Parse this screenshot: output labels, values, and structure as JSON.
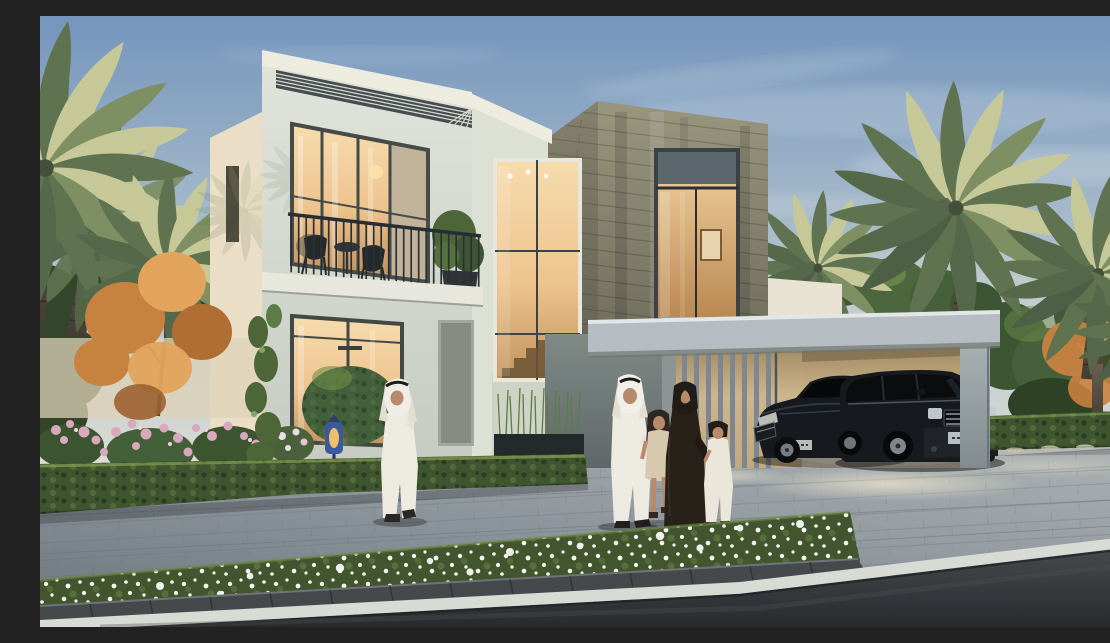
{
  "scene": {
    "type": "architectural-exterior-rendering",
    "description": "Dusk rendering of a modern two-storey villa: white block with louvred roof edge and balcony, double-height stair window, stone-clad wing with glowing window, slatted entrance screen, open carport sheltering a dark sedan and SUV, an Emirati family of four walking on the block-paved driveway, a man in a white kandura on the phone, date palms, autumn trees, pink shrubs, clipped hedges, a foreground bed of white daisies and an asphalt road with a white edge line.",
    "objects": [
      {
        "name": "villa-left-block",
        "label": "white two-storey block with roof louvres"
      },
      {
        "name": "balcony",
        "label": "balcony with metal railing, two chairs and bistro table"
      },
      {
        "name": "stairwell-window",
        "label": "double-height stair window, warm lit"
      },
      {
        "name": "stone-block",
        "label": "stone-clad volume with tall lit window"
      },
      {
        "name": "entrance-gate",
        "label": "vertical slatted entrance screen"
      },
      {
        "name": "carport",
        "label": "open carport with two parked cars"
      },
      {
        "name": "suv",
        "label": "dark luxury SUV"
      },
      {
        "name": "sedan",
        "label": "dark luxury sedan"
      },
      {
        "name": "family-group",
        "label": "father, mother, daughter and son walking"
      },
      {
        "name": "man-walking",
        "label": "man in white kandura talking on the phone"
      },
      {
        "name": "palm-trees",
        "label": "date palms framing the house"
      },
      {
        "name": "autumn-trees",
        "label": "orange-leaved ornamental trees"
      },
      {
        "name": "flower-garden",
        "label": "pink flowering shrubs behind clipped hedge"
      },
      {
        "name": "flower-bed",
        "label": "foreground bed of white daisies"
      },
      {
        "name": "driveway",
        "label": "grey block-paved driveway and sidewalk"
      },
      {
        "name": "road",
        "label": "asphalt road with white edge line"
      },
      {
        "name": "lantern",
        "label": "blue Moroccan lantern with amber glow"
      }
    ],
    "palette": {
      "sky_top": "#7495bc",
      "sky_mid": "#a9bccb",
      "sky_horizon": "#e4e1d4",
      "wall_light": "#d4d8cf",
      "wall_warm": "#eadfc6",
      "fascia": "#edecdf",
      "stone": "#8d8a73",
      "stone_dark": "#6f6d5b",
      "glass_warm": "#eec48f",
      "glass_deep": "#c2935d",
      "frame_dark": "#3b4245",
      "hedge": "#3f5530",
      "hedge_light": "#6d8c49",
      "foliage": "#4c6638",
      "foliage_dark": "#31452a",
      "palm_lit": "#c6c997",
      "palm_shade": "#5f7350",
      "trunk": "#5a4f41",
      "autumn": "#c8823f",
      "autumn_light": "#e2a45b",
      "blossom": "#d8a8bd",
      "paver": "#8f979e",
      "paver_dark": "#747c84",
      "paver_light": "#c9c7b9",
      "asphalt": "#34383b",
      "curb_line": "#d8dad4",
      "concrete": "#9aa2a6",
      "carport_wall": "#cdb68d",
      "carport_floor": "#d9d3c0",
      "car_black": "#16191d",
      "car_trim": "#7e858b",
      "thobe": "#edeae1",
      "abaya": "#282119",
      "skin": "#b68a6a",
      "dress": "#d6c9ad",
      "window_glow": "#f2cf9b",
      "lantern_glow": "#eec06a",
      "lantern_blue": "#3a5a9e"
    }
  }
}
